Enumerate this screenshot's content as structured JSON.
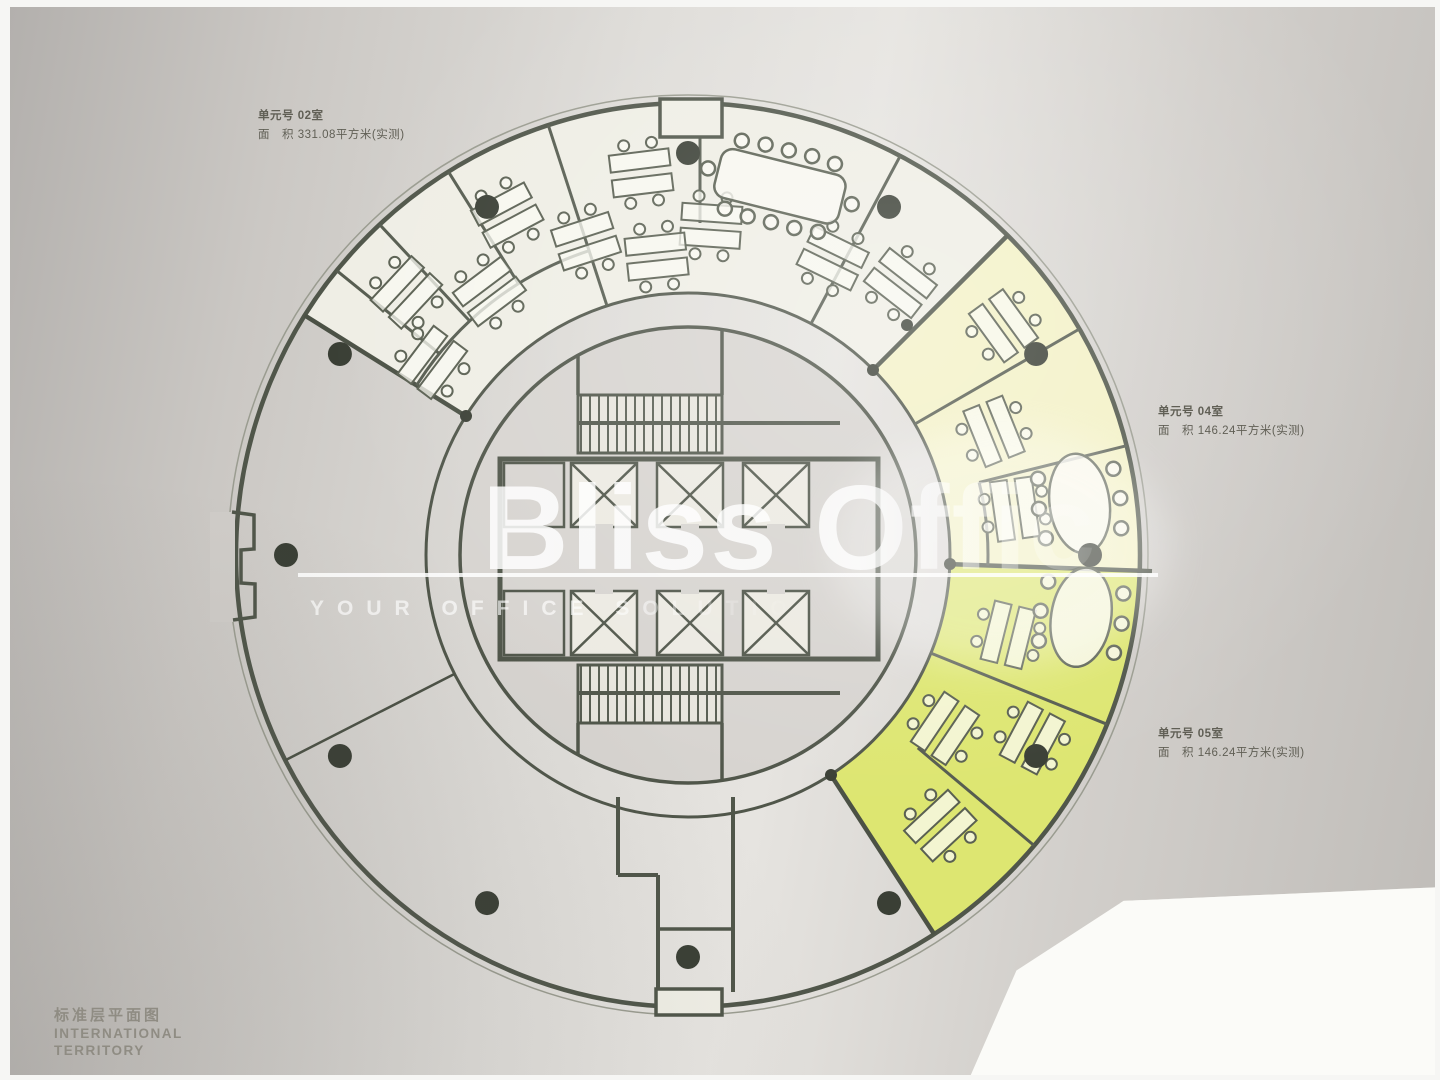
{
  "watermark": {
    "brand": "Bliss Office",
    "tagline": "YOUR OFFICE SOLUTION"
  },
  "units": [
    {
      "id": "02",
      "line1": "单元号 02室",
      "line2": "面　积 331.08平方米(实测)"
    },
    {
      "id": "04",
      "line1": "单元号 04室",
      "line2": "面　积 146.24平方米(实测)"
    },
    {
      "id": "05",
      "line1": "单元号 05室",
      "line2": "面　积 146.24平方米(实测)"
    }
  ],
  "logo": {
    "cn": "标准层平面图",
    "en1": "INTERNATIONAL",
    "en2": "TERRITORY"
  },
  "colors": {
    "paper": "#cfccc8",
    "plan_white": "#efeee5",
    "unit_04_fill": "#f3f1c6",
    "unit_05_fill": "#dde671",
    "wall": "#50564a",
    "column_dot": "#3a3f35",
    "watermark": "#ffffff"
  }
}
